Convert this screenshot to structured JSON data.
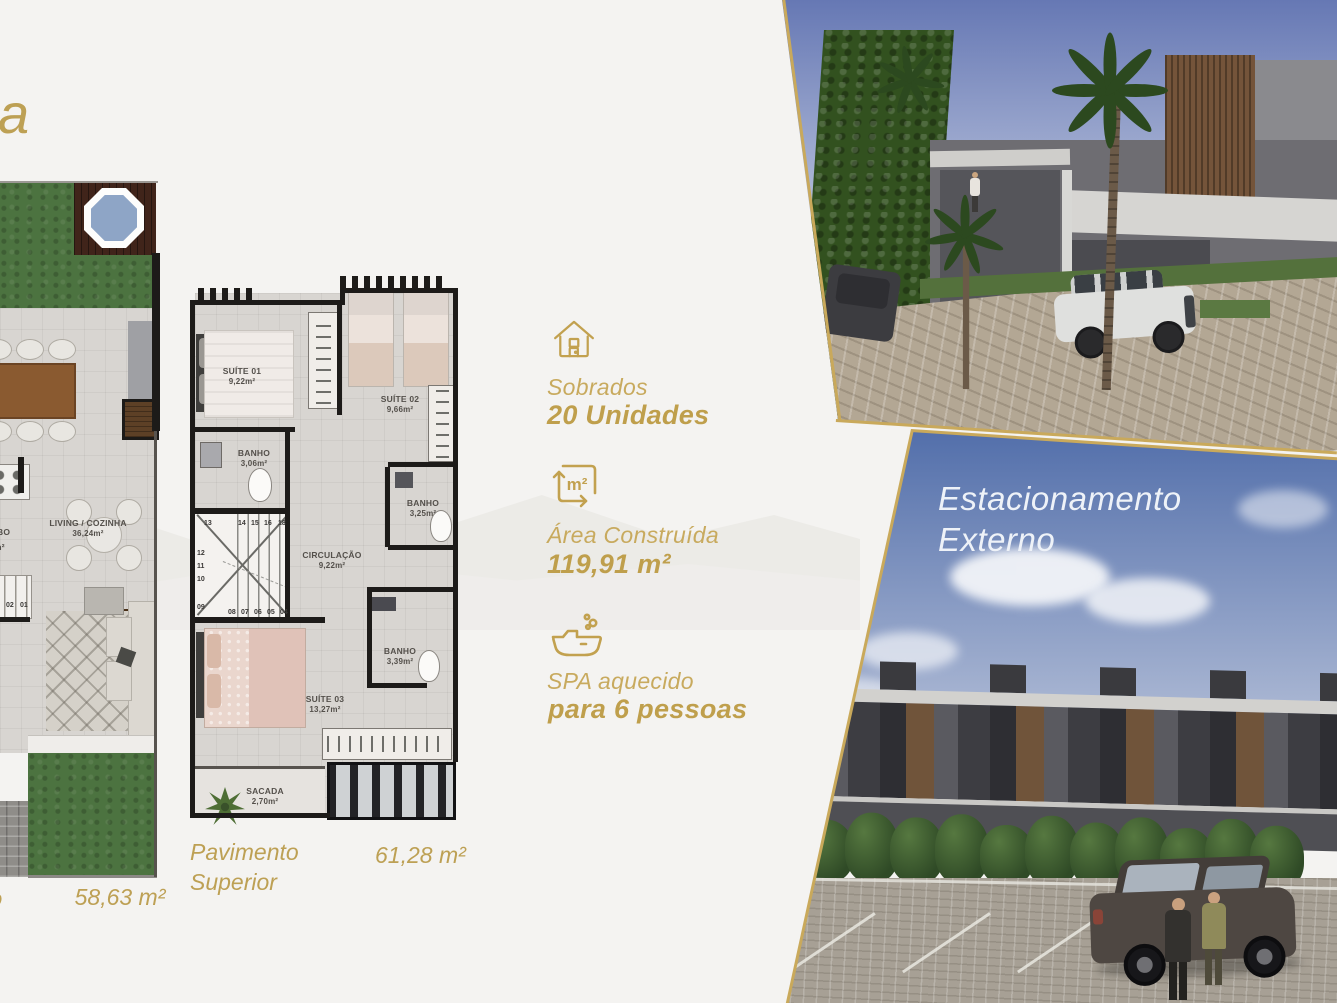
{
  "colors": {
    "accent_gold": "#c2a14f",
    "background": "#f4f3f1",
    "sky_blue": "#4f6ca9"
  },
  "header": {
    "partial_title": "a"
  },
  "ground_floor": {
    "area_total": "58,63 m²",
    "partial_caption": "o",
    "living_label": "LIVING / COZINHA",
    "living_area": "36,24m²",
    "lavabo_partial_name": "BO",
    "lavabo_partial_area": "m²",
    "stairs": [
      "03",
      "02",
      "01"
    ]
  },
  "upper_floor": {
    "caption_line1": "Pavimento",
    "caption_line2": "Superior",
    "area_total": "61,28 m²",
    "rooms": {
      "suite1": {
        "name": "SUÍTE 01",
        "area": "9,22m²"
      },
      "suite2": {
        "name": "SUÍTE 02",
        "area": "9,66m²"
      },
      "banho1": {
        "name": "BANHO",
        "area": "3,06m²"
      },
      "banho2": {
        "name": "BANHO",
        "area": "3,25m²"
      },
      "circulacao": {
        "name": "CIRCULAÇÃO",
        "area": "9,22m²"
      },
      "banho3": {
        "name": "BANHO",
        "area": "3,39m²"
      },
      "suite3": {
        "name": "SUÍTE 03",
        "area": "13,27m²"
      },
      "sacada": {
        "name": "SACADA",
        "area": "2,70m²"
      }
    },
    "stairs": {
      "top": [
        "13",
        "14",
        "15",
        "16",
        "18"
      ],
      "left": [
        "12",
        "11",
        "10",
        "09"
      ],
      "bottom": [
        "08",
        "07",
        "06",
        "05",
        "04"
      ]
    }
  },
  "features": [
    {
      "icon": "house-icon",
      "label": "Sobrados",
      "value": "20 Unidades"
    },
    {
      "icon": "area-icon",
      "icon_text": "m²",
      "label": "Área Construída",
      "value": "119,91 m²"
    },
    {
      "icon": "spa-icon",
      "label": "SPA aquecido",
      "value": "para 6 pessoas"
    }
  ],
  "parking_photo": {
    "title_line1": "Estacionamento",
    "title_line2": "Externo"
  }
}
